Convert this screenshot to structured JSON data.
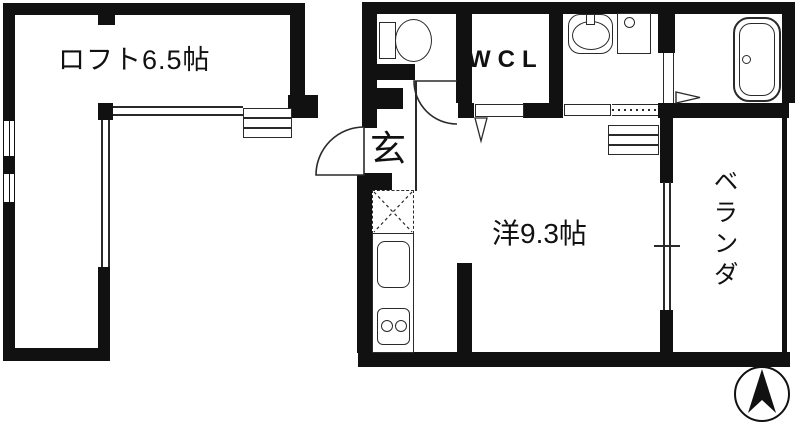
{
  "plan": {
    "type": "japanese-apartment-floor-plan",
    "rooms": {
      "loft": {
        "label": "ロフト6.5帖"
      },
      "wcl": {
        "label": "WCL"
      },
      "genkan": {
        "label": "玄"
      },
      "main_room": {
        "label": "洋9.3帖"
      },
      "veranda": {
        "label": "ベランダ"
      }
    },
    "icons": {
      "toilet": "toilet-icon",
      "washbasin": "washbasin-icon",
      "washing_machine": "washing-machine-icon",
      "bathtub": "bathtub-icon",
      "kitchen_sink": "kitchen-sink-icon",
      "stove": "two-burner-stove-icon",
      "refrigerator_space": "refrigerator-space-icon",
      "loft_ladder": "loft-ladder-icon",
      "compass": "north-arrow-icon"
    },
    "colors": {
      "wall": "#111111",
      "background": "#ffffff",
      "line": "#2a2a2a"
    }
  }
}
